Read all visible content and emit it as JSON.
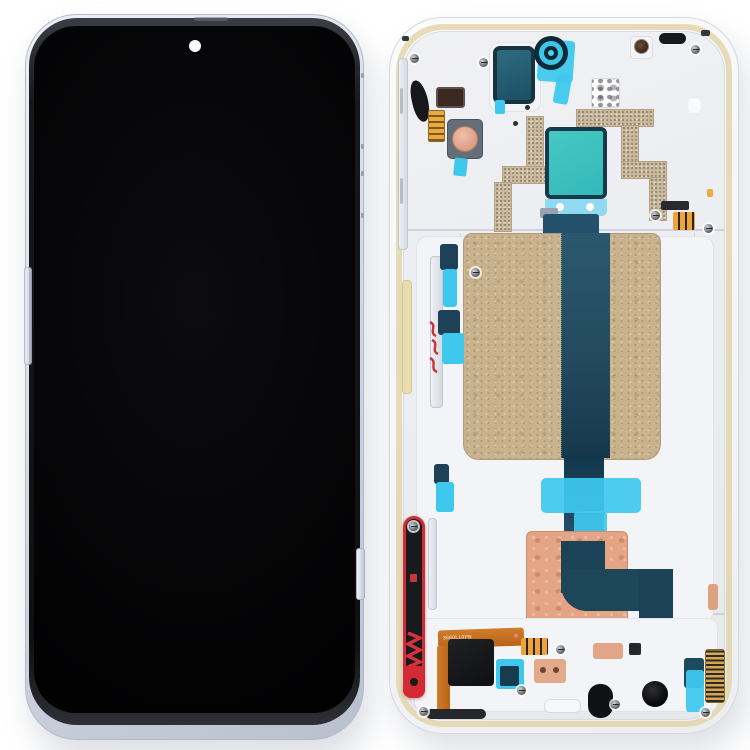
{
  "photo": {
    "subject": "phone LCD screen and middle frame replacement part, front and back views",
    "background_color": "#ffffff"
  },
  "front_assembly": {
    "screen_color": "#030304",
    "frame_color": "#d6dbe6",
    "bezel_color": "#141519",
    "camera_dot_color": "#ffffff",
    "buttons": [
      "volume-button",
      "power-button"
    ]
  },
  "back_assembly": {
    "shell_color": "#f2f3f6",
    "adhesive_lip_color": "#e2d2a4",
    "mid_plate_color": "#ebedf1",
    "graphite_sticker_color": "#c9b28e",
    "main_flex_color": "#24506a",
    "cyan_tape_color": "#3fc8ee",
    "teal_sticker_color": "#3cc0bd",
    "teal_sticker_border_color": "#16394b",
    "camera_ring_color": "#3cc6e8",
    "copper_patch_color": "#e3a586",
    "antenna_trace_color": "#c8b99e",
    "red_trigger_color": "#d42a33",
    "orange_flex_color": "#c97325",
    "gold_contact_color": "#e89a2e",
    "flex_label": "3660L10PB"
  }
}
